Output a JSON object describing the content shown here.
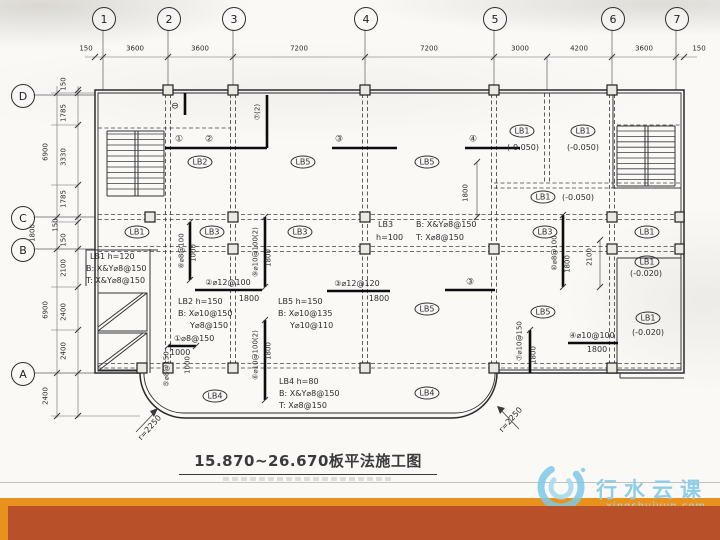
{
  "theme": {
    "accent_color": "#E8921D",
    "footer_color": "#B8502A",
    "paper_color": "#faf9f6",
    "ink_color": "#2c2c2c",
    "watermark_color": "#8FCDE9"
  },
  "title": {
    "text": "15.870~26.670板平法施工图"
  },
  "watermark": {
    "name": "行水云课",
    "domain": "xingshuiyun.com"
  },
  "plan": {
    "axes_top": [
      {
        "label": "1",
        "x": 103
      },
      {
        "label": "2",
        "x": 168
      },
      {
        "label": "3",
        "x": 233
      },
      {
        "label": "4",
        "x": 365
      },
      {
        "label": "5",
        "x": 494
      },
      {
        "label": "6",
        "x": 612
      },
      {
        "label": "7",
        "x": 676
      }
    ],
    "axes_left": [
      {
        "label": "D",
        "y": 95
      },
      {
        "label": "C",
        "y": 217
      },
      {
        "label": "B",
        "y": 249
      },
      {
        "label": "A",
        "y": 373
      }
    ],
    "labels": [
      {
        "t": "150",
        "x": 86,
        "y": 49,
        "s": 7,
        "n": "dim-label"
      },
      {
        "t": "3600",
        "x": 135,
        "y": 49,
        "s": 7,
        "n": "dim-label"
      },
      {
        "t": "3600",
        "x": 200,
        "y": 49,
        "s": 7,
        "n": "dim-label"
      },
      {
        "t": "7200",
        "x": 299,
        "y": 49,
        "s": 7,
        "n": "dim-label"
      },
      {
        "t": "7200",
        "x": 429,
        "y": 49,
        "s": 7,
        "n": "dim-label"
      },
      {
        "t": "3000",
        "x": 520,
        "y": 49,
        "s": 7,
        "n": "dim-label"
      },
      {
        "t": "4200",
        "x": 579,
        "y": 49,
        "s": 7,
        "n": "dim-label"
      },
      {
        "t": "3600",
        "x": 644,
        "y": 49,
        "s": 7,
        "n": "dim-label"
      },
      {
        "t": "150",
        "x": 699,
        "y": 49,
        "s": 7,
        "n": "dim-label"
      },
      {
        "t": "150",
        "x": 64,
        "y": 84,
        "s": 7,
        "r": -90,
        "n": "dim-label"
      },
      {
        "t": "1785",
        "x": 64,
        "y": 113,
        "s": 7,
        "r": -90,
        "n": "dim-label"
      },
      {
        "t": "3330",
        "x": 64,
        "y": 157,
        "s": 7,
        "r": -90,
        "n": "dim-label"
      },
      {
        "t": "1785",
        "x": 64,
        "y": 199,
        "s": 7,
        "r": -90,
        "n": "dim-label"
      },
      {
        "t": "150",
        "x": 56,
        "y": 225,
        "s": 7,
        "r": -90,
        "n": "dim-label"
      },
      {
        "t": "150",
        "x": 64,
        "y": 240,
        "s": 7,
        "r": -90,
        "n": "dim-label"
      },
      {
        "t": "2100",
        "x": 64,
        "y": 268,
        "s": 7,
        "r": -90,
        "n": "dim-label"
      },
      {
        "t": "2400",
        "x": 64,
        "y": 312,
        "s": 7,
        "r": -90,
        "n": "dim-label"
      },
      {
        "t": "2400",
        "x": 64,
        "y": 351,
        "s": 7,
        "r": -90,
        "n": "dim-label"
      },
      {
        "t": "6900",
        "x": 46,
        "y": 152,
        "s": 7,
        "r": -90,
        "n": "dim-label"
      },
      {
        "t": "6900",
        "x": 46,
        "y": 310,
        "s": 7,
        "r": -90,
        "n": "dim-label"
      },
      {
        "t": "2400",
        "x": 46,
        "y": 396,
        "s": 7,
        "r": -90,
        "n": "dim-label"
      },
      {
        "t": "1800",
        "x": 33,
        "y": 233,
        "s": 7,
        "r": -90,
        "n": "dim-label"
      },
      {
        "t": "LB2",
        "x": 200,
        "y": 162,
        "cls": "circ",
        "n": "slab-label"
      },
      {
        "t": "LB5",
        "x": 303,
        "y": 162,
        "cls": "circ",
        "n": "slab-label"
      },
      {
        "t": "LB5",
        "x": 427,
        "y": 162,
        "cls": "circ",
        "n": "slab-label"
      },
      {
        "t": "LB1",
        "x": 522,
        "y": 131,
        "cls": "circ",
        "n": "slab-label"
      },
      {
        "t": "LB1",
        "x": 583,
        "y": 131,
        "cls": "circ",
        "n": "slab-label"
      },
      {
        "t": "LB1",
        "x": 543,
        "y": 197,
        "cls": "circ",
        "n": "slab-label"
      },
      {
        "t": "LB1",
        "x": 137,
        "y": 232,
        "cls": "circ",
        "n": "slab-label"
      },
      {
        "t": "LB3",
        "x": 212,
        "y": 232,
        "cls": "circ",
        "n": "slab-label"
      },
      {
        "t": "LB3",
        "x": 300,
        "y": 232,
        "cls": "circ",
        "n": "slab-label"
      },
      {
        "t": "LB3",
        "x": 545,
        "y": 232,
        "cls": "circ",
        "n": "slab-label"
      },
      {
        "t": "LB1",
        "x": 647,
        "y": 232,
        "cls": "circ",
        "n": "slab-label"
      },
      {
        "t": "LB1",
        "x": 647,
        "y": 262,
        "cls": "circ",
        "n": "slab-label"
      },
      {
        "t": "LB5",
        "x": 427,
        "y": 309,
        "cls": "circ",
        "n": "slab-label"
      },
      {
        "t": "LB5",
        "x": 543,
        "y": 312,
        "cls": "circ",
        "n": "slab-label"
      },
      {
        "t": "LB1",
        "x": 648,
        "y": 318,
        "cls": "circ",
        "n": "slab-label"
      },
      {
        "t": "LB4",
        "x": 215,
        "y": 396,
        "cls": "circ",
        "n": "slab-label"
      },
      {
        "t": "LB4",
        "x": 427,
        "y": 393,
        "cls": "circ",
        "n": "slab-label"
      },
      {
        "t": "(-0.050)",
        "x": 523,
        "y": 148,
        "n": "elevation-label"
      },
      {
        "t": "(-0.050)",
        "x": 583,
        "y": 148,
        "n": "elevation-label"
      },
      {
        "t": "(-0.050)",
        "x": 578,
        "y": 198,
        "n": "elevation-label"
      },
      {
        "t": "(-0.020)",
        "x": 646,
        "y": 274,
        "n": "elevation-label"
      },
      {
        "t": "(-0.020)",
        "x": 648,
        "y": 333,
        "n": "elevation-label"
      },
      {
        "t": "LB1 h=120",
        "x": 90,
        "y": 257,
        "a": "l",
        "n": "slab-note"
      },
      {
        "t": "B: X&Y⌀8@150",
        "x": 86,
        "y": 269,
        "a": "l",
        "n": "slab-note"
      },
      {
        "t": "T: X&Y⌀8@150",
        "x": 86,
        "y": 281,
        "a": "l",
        "n": "slab-note"
      },
      {
        "t": "LB3",
        "x": 378,
        "y": 225,
        "a": "l",
        "n": "slab-note"
      },
      {
        "t": "h=100",
        "x": 376,
        "y": 238,
        "a": "l",
        "n": "slab-note"
      },
      {
        "t": "B: X&Y⌀8@150",
        "x": 416,
        "y": 225,
        "a": "l",
        "n": "slab-note"
      },
      {
        "t": "T: X⌀8@150",
        "x": 416,
        "y": 238,
        "a": "l",
        "n": "slab-note"
      },
      {
        "t": "LB2 h=150",
        "x": 178,
        "y": 302,
        "a": "l",
        "n": "slab-note"
      },
      {
        "t": "B: X⌀10@150",
        "x": 178,
        "y": 314,
        "a": "l",
        "n": "slab-note"
      },
      {
        "t": "Y⌀8@150",
        "x": 190,
        "y": 326,
        "a": "l",
        "n": "slab-note"
      },
      {
        "t": "①⌀8@150",
        "x": 174,
        "y": 339,
        "a": "l",
        "n": "rebar-label"
      },
      {
        "t": "1000",
        "x": 170,
        "y": 353,
        "a": "l",
        "n": "dim-label"
      },
      {
        "t": "LB5 h=150",
        "x": 278,
        "y": 302,
        "a": "l",
        "n": "slab-note"
      },
      {
        "t": "B: X⌀10@135",
        "x": 278,
        "y": 314,
        "a": "l",
        "n": "slab-note"
      },
      {
        "t": "Y⌀10@110",
        "x": 290,
        "y": 326,
        "a": "l",
        "n": "slab-note"
      },
      {
        "t": "LB4 h=80",
        "x": 279,
        "y": 382,
        "a": "l",
        "n": "slab-note"
      },
      {
        "t": "B: X&Y⌀8@150",
        "x": 279,
        "y": 394,
        "a": "l",
        "n": "slab-note"
      },
      {
        "t": "T: X⌀8@150",
        "x": 279,
        "y": 406,
        "a": "l",
        "n": "slab-note"
      },
      {
        "t": "②⌀12@100",
        "x": 228,
        "y": 283,
        "n": "rebar-label"
      },
      {
        "t": "1800",
        "x": 249,
        "y": 299,
        "n": "dim-label"
      },
      {
        "t": "③⌀12@120",
        "x": 357,
        "y": 284,
        "n": "rebar-label"
      },
      {
        "t": "1800",
        "x": 379,
        "y": 299,
        "n": "dim-label"
      },
      {
        "t": "④⌀10@100",
        "x": 592,
        "y": 336,
        "n": "rebar-label"
      },
      {
        "t": "1800",
        "x": 597,
        "y": 350,
        "n": "dim-label"
      },
      {
        "t": "①",
        "x": 179,
        "y": 140,
        "s": 9,
        "n": "rebar-mark"
      },
      {
        "t": "②",
        "x": 209,
        "y": 140,
        "s": 9,
        "n": "rebar-mark"
      },
      {
        "t": "③",
        "x": 339,
        "y": 140,
        "s": 9,
        "n": "rebar-mark"
      },
      {
        "t": "④",
        "x": 473,
        "y": 140,
        "s": 9,
        "n": "rebar-mark"
      },
      {
        "t": "③",
        "x": 470,
        "y": 283,
        "s": 9,
        "n": "rebar-mark"
      },
      {
        "t": "⊖",
        "x": 175,
        "y": 107,
        "s": 9,
        "n": "section-mark"
      },
      {
        "t": "⑦(2)",
        "x": 258,
        "y": 112,
        "s": 7,
        "r": -90,
        "n": "rebar-label"
      },
      {
        "t": "⑧⌀8@100",
        "x": 182,
        "y": 251,
        "s": 7,
        "r": -90,
        "n": "rebar-label"
      },
      {
        "t": "1000",
        "x": 194,
        "y": 253,
        "s": 7,
        "r": -90,
        "n": "dim-label"
      },
      {
        "t": "⑨⌀10@100(2)",
        "x": 256,
        "y": 252,
        "s": 7,
        "r": -90,
        "n": "rebar-label"
      },
      {
        "t": "1800",
        "x": 269,
        "y": 258,
        "s": 7,
        "r": -90,
        "n": "dim-label"
      },
      {
        "t": "⑩⌀8@100",
        "x": 555,
        "y": 253,
        "s": 7,
        "r": -90,
        "n": "rebar-label"
      },
      {
        "t": "1800",
        "x": 568,
        "y": 264,
        "s": 7,
        "r": -90,
        "n": "dim-label"
      },
      {
        "t": "2100",
        "x": 590,
        "y": 257,
        "s": 7,
        "r": -90,
        "n": "dim-label"
      },
      {
        "t": "1800",
        "x": 466,
        "y": 193,
        "s": 7,
        "r": -90,
        "n": "dim-label"
      },
      {
        "t": "⑤⌀8@150",
        "x": 167,
        "y": 369,
        "s": 7,
        "r": -90,
        "n": "rebar-label"
      },
      {
        "t": "1000",
        "x": 188,
        "y": 365,
        "s": 7,
        "r": -90,
        "n": "dim-label"
      },
      {
        "t": "⑥⌀10@100(2)",
        "x": 256,
        "y": 355,
        "s": 7,
        "r": -90,
        "n": "rebar-label"
      },
      {
        "t": "1800",
        "x": 269,
        "y": 351,
        "s": 7,
        "r": -90,
        "n": "dim-label"
      },
      {
        "t": "⑦⌀10@150",
        "x": 520,
        "y": 341,
        "s": 7,
        "r": -90,
        "n": "rebar-label"
      },
      {
        "t": "1800",
        "x": 534,
        "y": 355,
        "s": 7,
        "r": -90,
        "n": "dim-label"
      },
      {
        "t": "r=2250",
        "x": 150,
        "y": 428,
        "r": -48,
        "n": "radius-label"
      },
      {
        "t": "r=2250",
        "x": 511,
        "y": 420,
        "r": -48,
        "n": "radius-label"
      }
    ]
  }
}
